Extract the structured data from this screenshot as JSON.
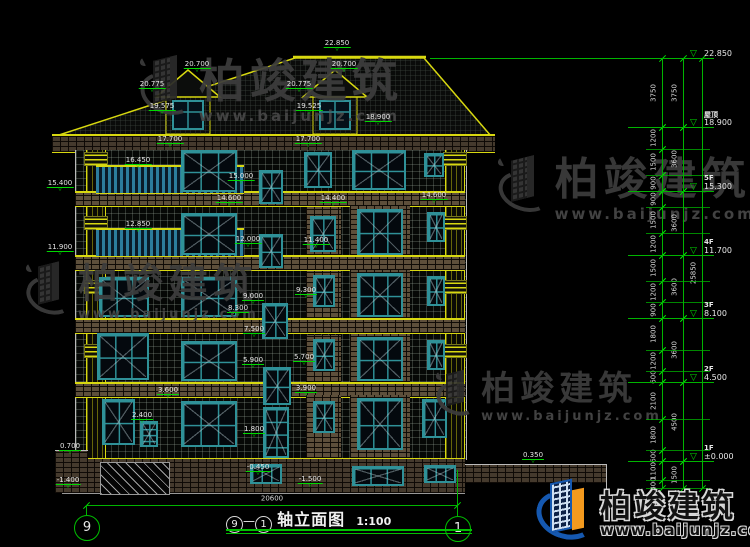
{
  "drawing": {
    "axis_from": "9",
    "axis_to": "1",
    "title_name": "轴立面图",
    "title_scale": "1:100",
    "bottom_dimension": "20600"
  },
  "levels": [
    {
      "label": "",
      "value": "22.850",
      "y": 58
    },
    {
      "label": "屋顶",
      "value": "18.900",
      "y": 127
    },
    {
      "label": "5F",
      "value": "15.300",
      "y": 191
    },
    {
      "label": "4F",
      "value": "11.700",
      "y": 255
    },
    {
      "label": "3F",
      "value": "8.100",
      "y": 318
    },
    {
      "label": "2F",
      "value": "4.500",
      "y": 382
    },
    {
      "label": "1F",
      "value": "±0.000",
      "y": 461
    }
  ],
  "dim_col1": [
    {
      "v": "3750",
      "y1": 58,
      "y2": 127
    },
    {
      "v": "1200",
      "y1": 127,
      "y2": 149
    },
    {
      "v": "1500",
      "y1": 149,
      "y2": 175
    },
    {
      "v": "900",
      "y1": 175,
      "y2": 191
    },
    {
      "v": "900",
      "y1": 191,
      "y2": 207
    },
    {
      "v": "1500",
      "y1": 207,
      "y2": 233
    },
    {
      "v": "1200",
      "y1": 233,
      "y2": 255
    },
    {
      "v": "1500",
      "y1": 255,
      "y2": 281
    },
    {
      "v": "1200",
      "y1": 281,
      "y2": 302
    },
    {
      "v": "900",
      "y1": 302,
      "y2": 318
    },
    {
      "v": "1800",
      "y1": 318,
      "y2": 350
    },
    {
      "v": "1200",
      "y1": 350,
      "y2": 371
    },
    {
      "v": "600",
      "y1": 371,
      "y2": 382
    },
    {
      "v": "2100",
      "y1": 382,
      "y2": 419
    },
    {
      "v": "1800",
      "y1": 419,
      "y2": 450
    },
    {
      "v": "600",
      "y1": 450,
      "y2": 461
    },
    {
      "v": "1100",
      "y1": 461,
      "y2": 480
    },
    {
      "v": "400",
      "y1": 480,
      "y2": 488
    }
  ],
  "dim_col2": [
    {
      "v": "3750",
      "y1": 58,
      "y2": 127
    },
    {
      "v": "3600",
      "y1": 127,
      "y2": 191
    },
    {
      "v": "3600",
      "y1": 191,
      "y2": 255
    },
    {
      "v": "3600",
      "y1": 255,
      "y2": 318
    },
    {
      "v": "3600",
      "y1": 318,
      "y2": 382
    },
    {
      "v": "4500",
      "y1": 382,
      "y2": 461
    },
    {
      "v": "1500",
      "y1": 461,
      "y2": 488
    }
  ],
  "dim_col3": [
    {
      "v": "25850",
      "y1": 58,
      "y2": 488
    }
  ],
  "annotations": [
    {
      "t": "22.850",
      "x": 337,
      "y": 40
    },
    {
      "t": "20.700",
      "x": 197,
      "y": 61
    },
    {
      "t": "20.775",
      "x": 152,
      "y": 81
    },
    {
      "t": "19.575",
      "x": 162,
      "y": 103
    },
    {
      "t": "20.700",
      "x": 344,
      "y": 61
    },
    {
      "t": "20.775",
      "x": 299,
      "y": 81
    },
    {
      "t": "19.525",
      "x": 309,
      "y": 103
    },
    {
      "t": "18.900",
      "x": 378,
      "y": 114
    },
    {
      "t": "17.700",
      "x": 170,
      "y": 136
    },
    {
      "t": "17.700",
      "x": 308,
      "y": 136
    },
    {
      "t": "16.450",
      "x": 138,
      "y": 157
    },
    {
      "t": "15.400",
      "x": 60,
      "y": 180
    },
    {
      "t": "15.000",
      "x": 241,
      "y": 173
    },
    {
      "t": "14.600",
      "x": 229,
      "y": 195
    },
    {
      "t": "14.400",
      "x": 333,
      "y": 195
    },
    {
      "t": "14.600",
      "x": 434,
      "y": 192
    },
    {
      "t": "12.850",
      "x": 138,
      "y": 221
    },
    {
      "t": "11.900",
      "x": 60,
      "y": 244
    },
    {
      "t": "12.000",
      "x": 248,
      "y": 236
    },
    {
      "t": "11.400",
      "x": 316,
      "y": 237
    },
    {
      "t": "9.300",
      "x": 306,
      "y": 287
    },
    {
      "t": "9.000",
      "x": 253,
      "y": 293
    },
    {
      "t": "8.300",
      "x": 238,
      "y": 305
    },
    {
      "t": "7.500",
      "x": 254,
      "y": 326
    },
    {
      "t": "5.900",
      "x": 253,
      "y": 357
    },
    {
      "t": "5.700",
      "x": 304,
      "y": 354
    },
    {
      "t": "3.900",
      "x": 306,
      "y": 385
    },
    {
      "t": "3.600",
      "x": 168,
      "y": 387
    },
    {
      "t": "2.400",
      "x": 142,
      "y": 412
    },
    {
      "t": "1.800",
      "x": 254,
      "y": 426
    },
    {
      "t": "0.700",
      "x": 70,
      "y": 443
    },
    {
      "t": "0.350",
      "x": 533,
      "y": 452
    },
    {
      "t": "-0.450",
      "x": 258,
      "y": 464
    },
    {
      "t": "-1.400",
      "x": 68,
      "y": 477
    },
    {
      "t": "-1.500",
      "x": 310,
      "y": 476
    }
  ],
  "watermarks": [
    {
      "text": "柏竣建筑",
      "url": "www.baijunjz.com",
      "x": 140,
      "y": 56,
      "size": 46,
      "urlsize": 15
    },
    {
      "text": "柏竣建筑",
      "url": "www.baijunjz.com",
      "x": 498,
      "y": 156,
      "size": 44,
      "urlsize": 15
    },
    {
      "text": "柏竣建筑",
      "url": "www.baijunjz.com",
      "x": 26,
      "y": 262,
      "size": 40,
      "urlsize": 13
    },
    {
      "text": "柏竣建筑",
      "url": "www.baijunjz.com",
      "x": 436,
      "y": 370,
      "size": 34,
      "urlsize": 13
    }
  ],
  "logo": {
    "text": "柏竣建筑",
    "url": "www.baijunjz.com"
  },
  "colors": {
    "background": "#000000",
    "cad_yellow": "#d8d810",
    "dimension_green": "#00c000",
    "window_teal": "#2f9198",
    "brick_brown": "#5d4f3b",
    "logo_blue": "#1558b0",
    "logo_orange": "#f39a1e"
  }
}
